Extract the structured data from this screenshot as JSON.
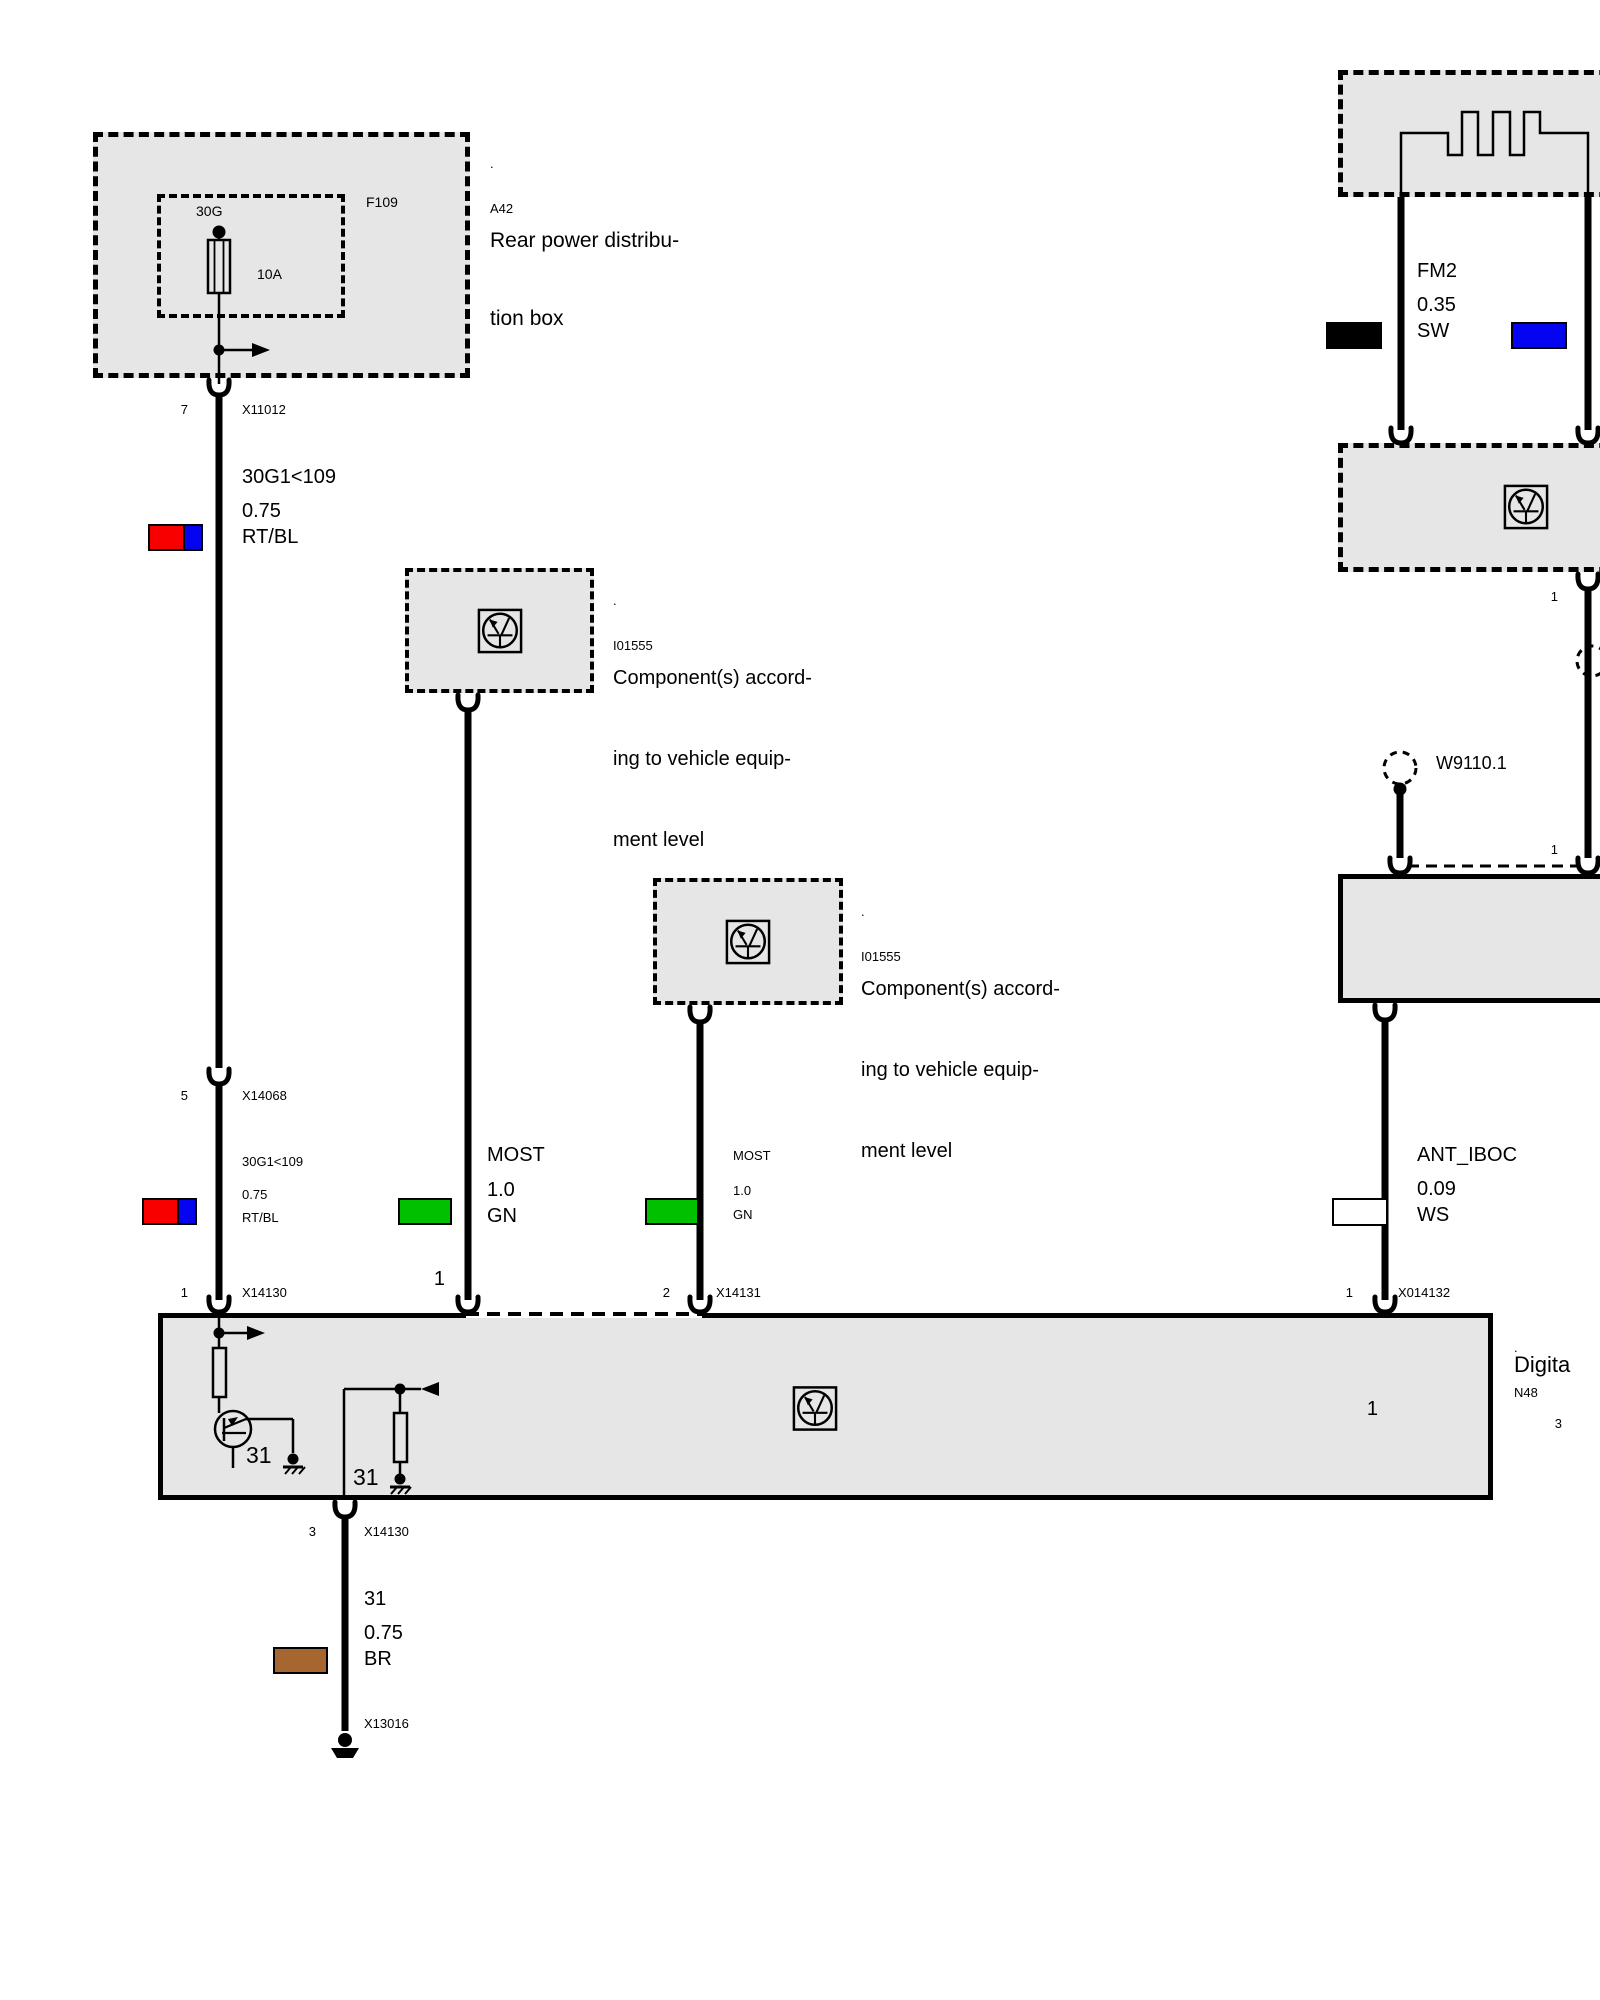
{
  "colors": {
    "box_fill": "#e6e6e6",
    "wire_red": "#f80000",
    "wire_blue": "#0404f0",
    "wire_green": "#00c000",
    "wire_black": "#000000",
    "wire_white": "#ffffff",
    "wire_brown": "#a5662f"
  },
  "power_box": {
    "dot": ".",
    "code": "A42",
    "name1": "Rear power distribu-",
    "name2": "tion box",
    "fuse_code": "F109",
    "fuse_feed": "30G",
    "fuse_rating": "10A"
  },
  "components": {
    "i01555a": {
      "dot": ".",
      "code": "I01555",
      "desc1": "Component(s) accord-",
      "desc2": "ing to vehicle equip-",
      "desc3": "ment level"
    },
    "i01555b": {
      "dot": ".",
      "code": "I01555",
      "desc1": "Component(s) accord-",
      "desc2": "ing to vehicle equip-",
      "desc3": "ment level"
    },
    "n48": {
      "dot": ".",
      "code": "N48",
      "name": "Digita"
    },
    "w9110": {
      "label": "W9110.1"
    }
  },
  "wires": {
    "power_upper": {
      "circuit": "30G1<109",
      "size": "0.75",
      "color": "RT/BL"
    },
    "power_lower": {
      "circuit": "30G1<109",
      "size": "0.75",
      "color": "RT/BL"
    },
    "most1": {
      "circuit": "MOST",
      "size": "1.0",
      "color": "GN"
    },
    "most2": {
      "circuit": "MOST",
      "size": "1.0",
      "color": "GN"
    },
    "fm": {
      "circuit": "FM2",
      "size": "0.35",
      "color": "SW"
    },
    "ant": {
      "circuit": "ANT_IBOC",
      "size": "0.09",
      "color": "WS"
    },
    "gnd": {
      "circuit": "31",
      "size": "0.75",
      "color": "BR"
    }
  },
  "pins": {
    "p7": "7",
    "x11012": "X11012",
    "p5": "5",
    "x14068": "X14068",
    "p1_power": "1",
    "x14130_top": "X14130",
    "p1_most": "1",
    "p2_most": "2",
    "x14131": "X14131",
    "p1_ant": "1",
    "x014132": "X014132",
    "p1_fm": "1",
    "p3_fm": "3",
    "p1_coax_a": "1",
    "p1_coax_b": "1",
    "p3_gnd": "3",
    "x14130_bottom": "X14130",
    "x13016": "X13016"
  },
  "internal": {
    "gnd_left": "31",
    "gnd_right": "31"
  }
}
